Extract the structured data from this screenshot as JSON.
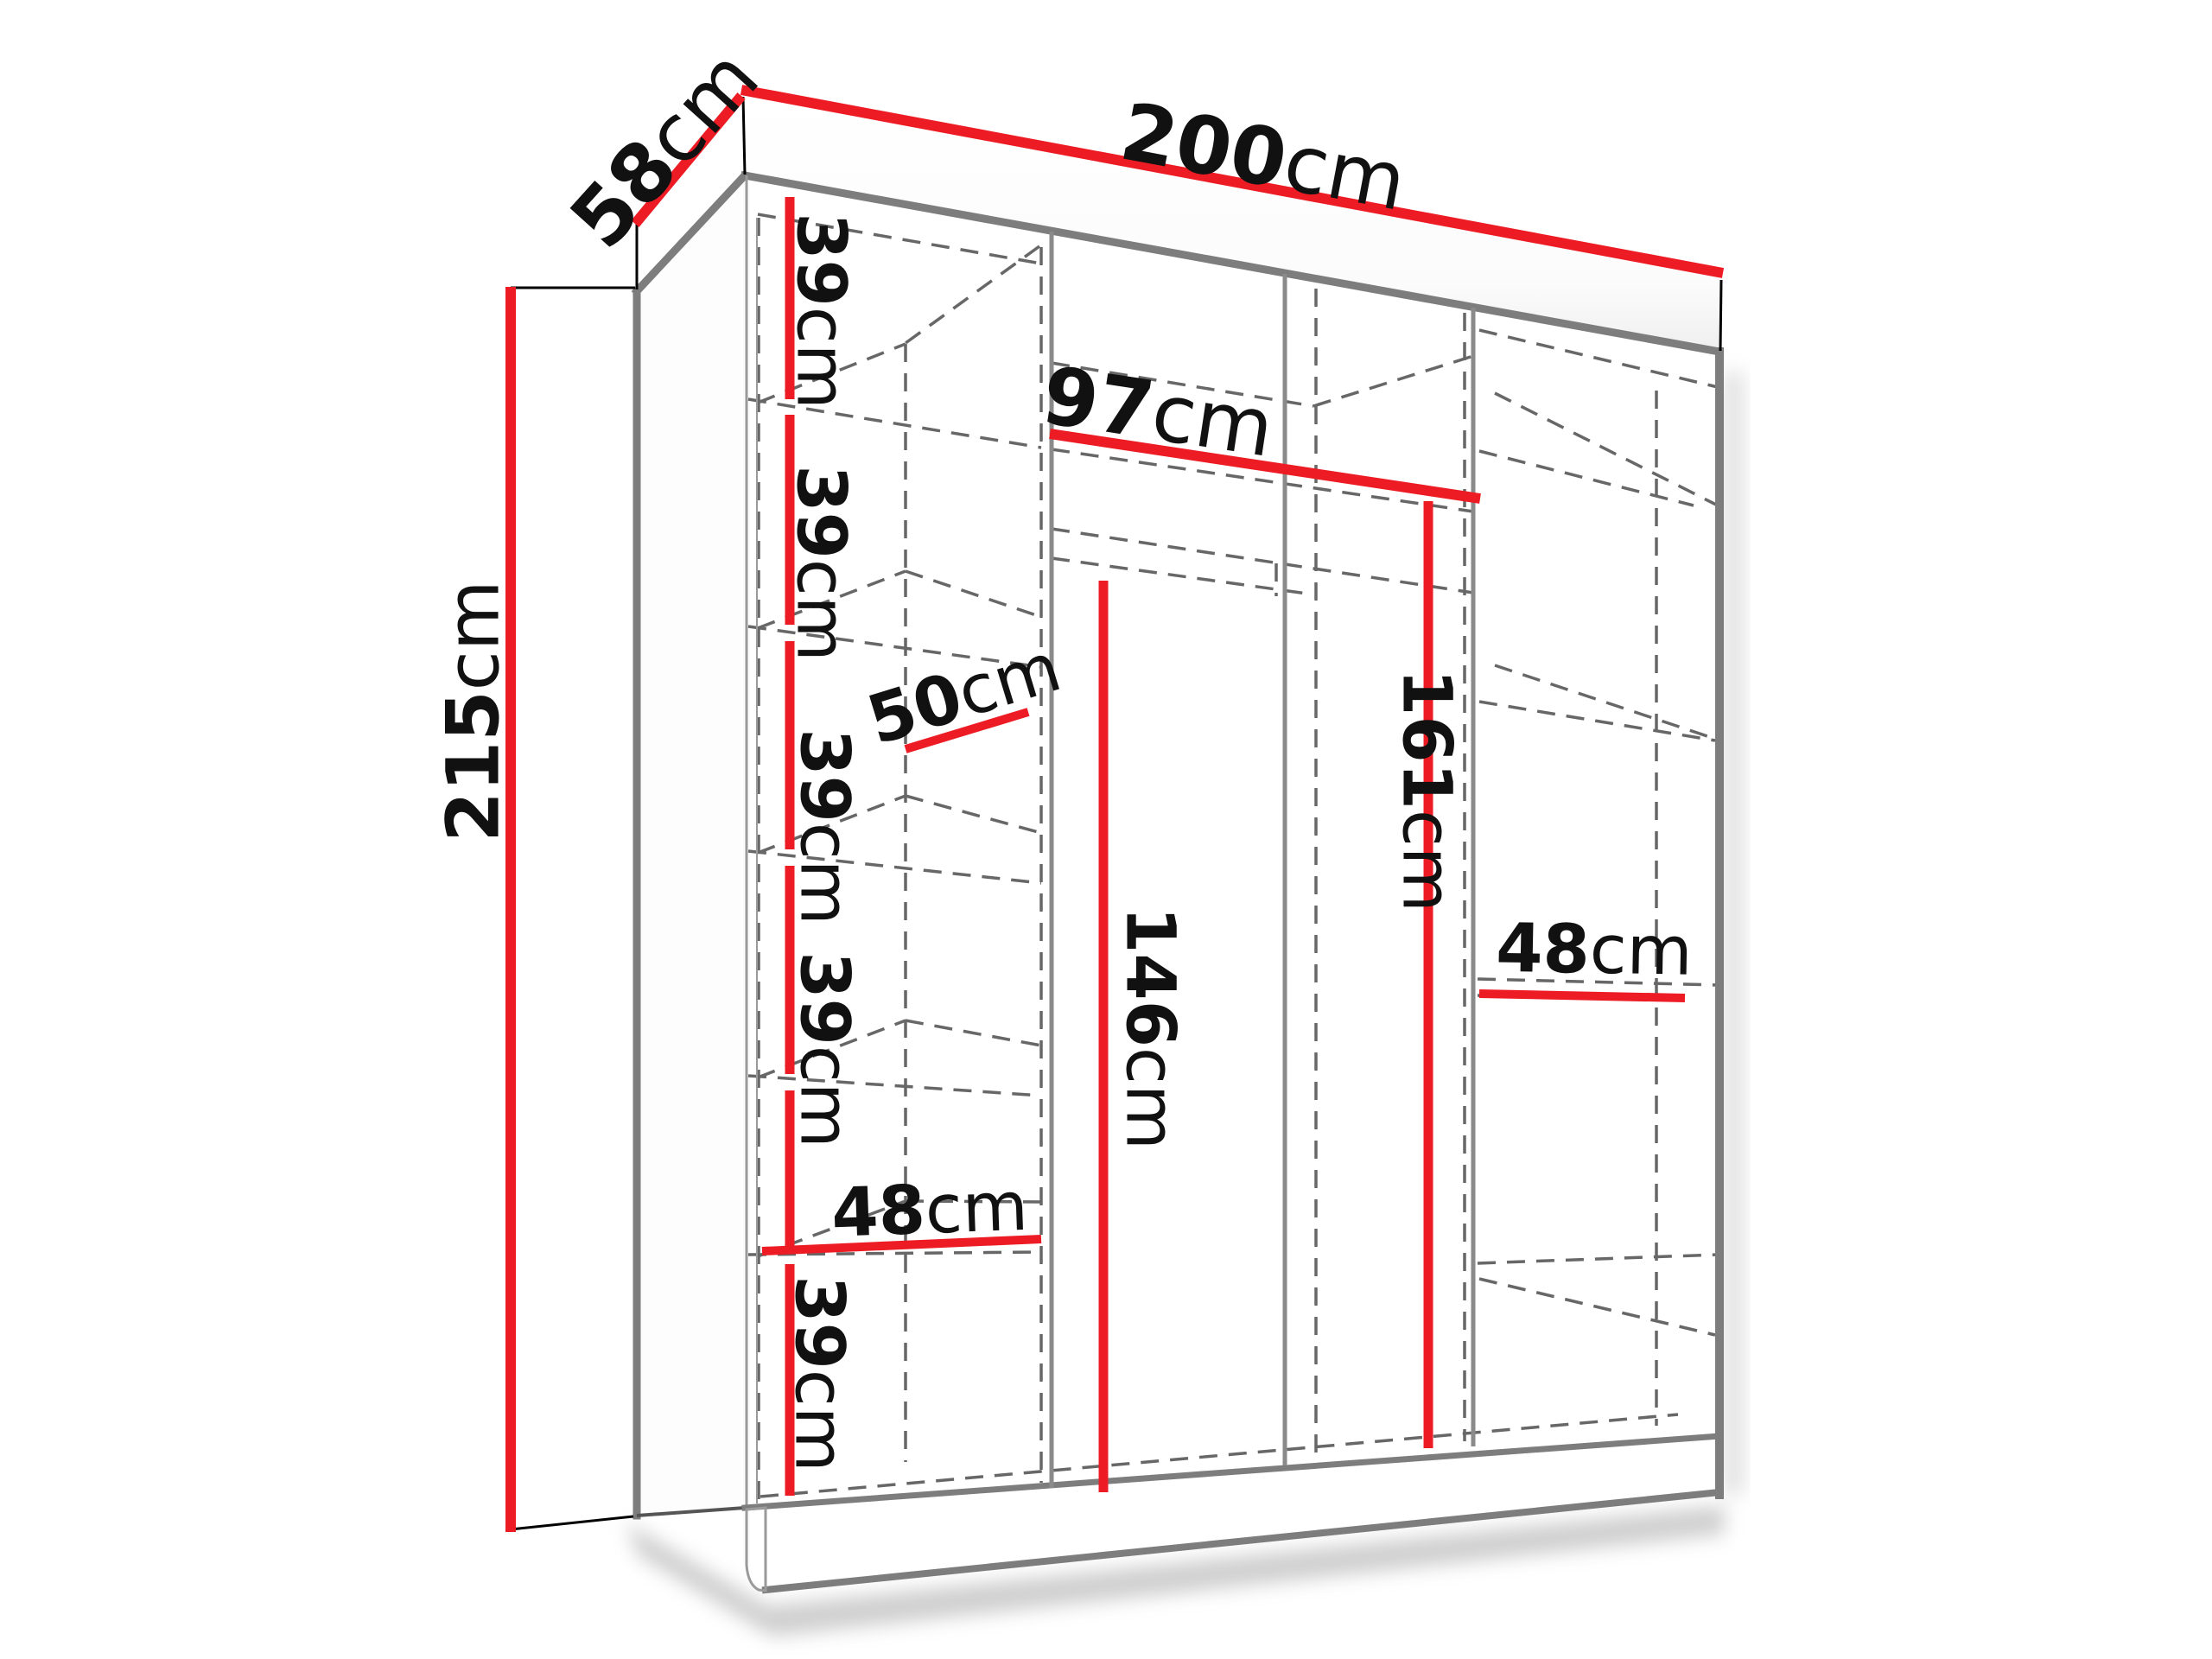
{
  "diagram": {
    "kind": "wardrobe-dimension-diagram",
    "object": "sliding-door wardrobe interior with shelves and hanging rails",
    "units": "cm",
    "overall": {
      "width_cm": 200,
      "depth_cm": 58,
      "height_cm": 215
    },
    "labels": {
      "width_top": {
        "num": "200",
        "unit": "cm"
      },
      "depth_top": {
        "num": "58",
        "unit": "cm"
      },
      "height_left": {
        "num": "215",
        "unit": "cm"
      },
      "shelf_1": {
        "num": "39",
        "unit": "cm"
      },
      "shelf_2": {
        "num": "39",
        "unit": "cm"
      },
      "shelf_3": {
        "num": "39",
        "unit": "cm"
      },
      "shelf_4": {
        "num": "39",
        "unit": "cm"
      },
      "shelf_5": {
        "num": "39",
        "unit": "cm"
      },
      "col_width_left": {
        "num": "48",
        "unit": "cm"
      },
      "shelf_depth": {
        "num": "50",
        "unit": "cm"
      },
      "mid_width": {
        "num": "97",
        "unit": "cm"
      },
      "mid_height_left": {
        "num": "146",
        "unit": "cm"
      },
      "mid_height_right": {
        "num": "161",
        "unit": "cm"
      },
      "col_width_right": {
        "num": "48",
        "unit": "cm"
      }
    },
    "colors": {
      "dimension_red": "#ed1c24",
      "edge_gray": "#7d7d7d",
      "dashed_gray": "#676767",
      "text_black": "#111111",
      "background": "#ffffff"
    }
  }
}
